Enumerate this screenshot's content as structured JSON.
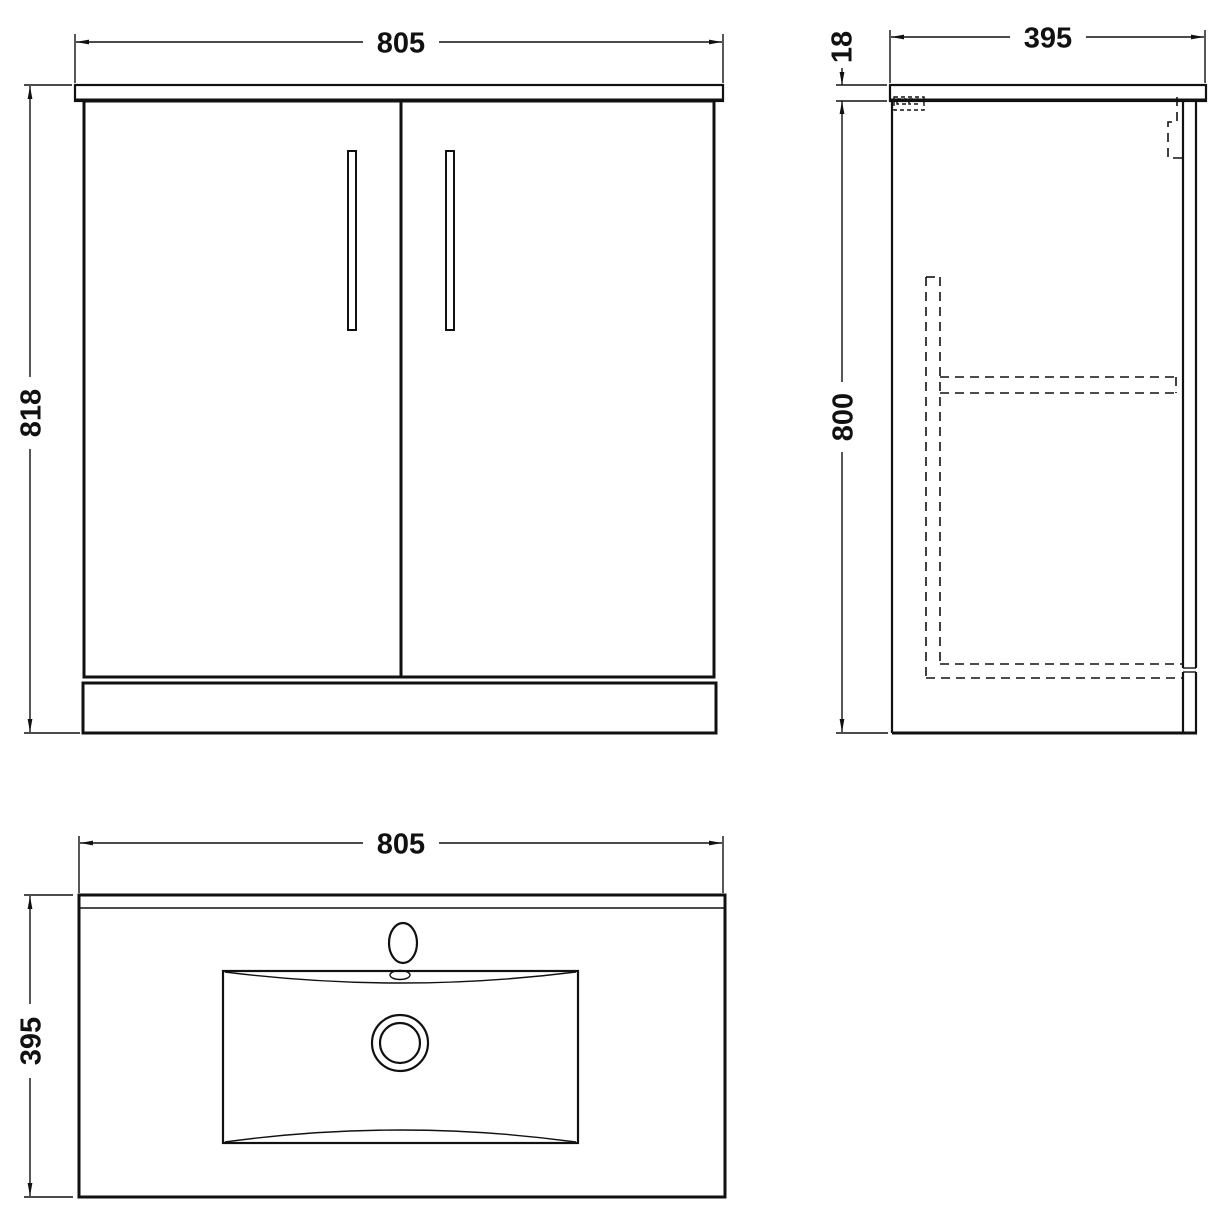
{
  "drawing": {
    "title": "vanity-unit-technical-drawing",
    "front_view": {
      "width_label": "805",
      "height_label": "818"
    },
    "side_view": {
      "worktop_thickness_label": "18",
      "depth_label": "395",
      "body_height_label": "800"
    },
    "plan_view": {
      "width_label": "805",
      "depth_label": "395"
    }
  }
}
